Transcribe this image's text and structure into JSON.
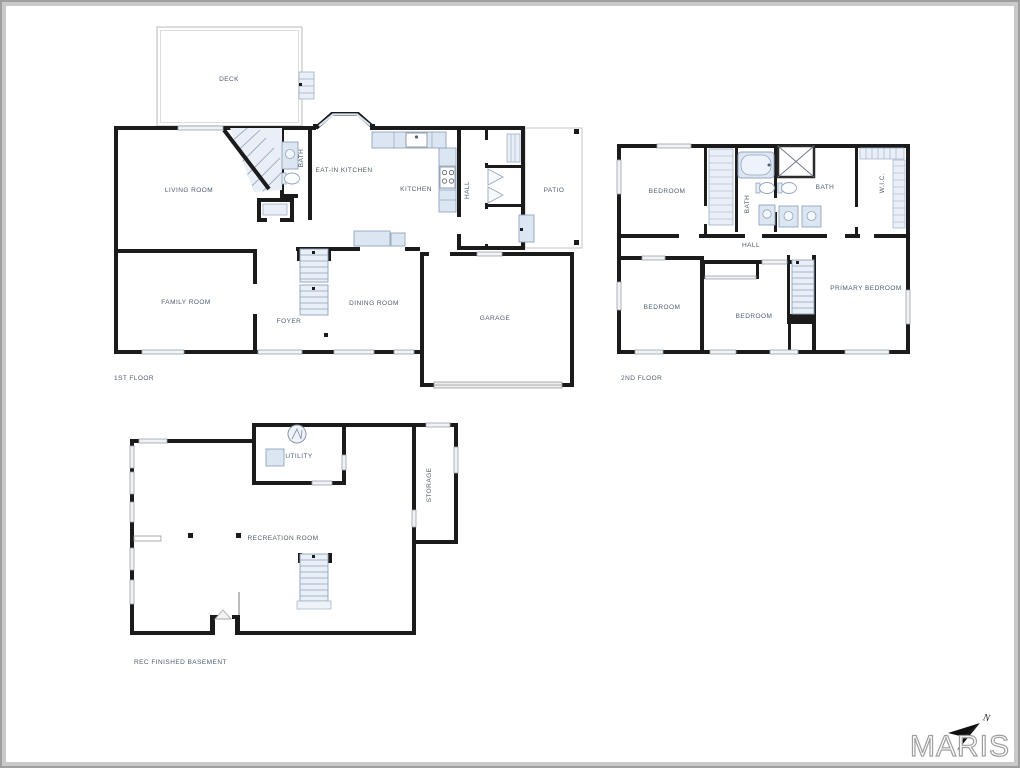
{
  "page": {
    "background": "#ffffff",
    "frame_outer_color": "#9e9e9e",
    "frame_inner_color": "#c9c9c9"
  },
  "palette": {
    "wall": "#1b1b1b",
    "fixture_fill": "#dce6f2",
    "fixture_stroke": "#92a5bd",
    "window_fill": "#f0f2f5",
    "label_color": "#4d5c6e",
    "logo_outline": "#9e9e9e"
  },
  "branding": {
    "logo_text": "MARIS",
    "north_label": "N"
  },
  "floors": [
    {
      "id": "first-floor",
      "title": "1ST FLOOR",
      "rooms": [
        {
          "label": "DECK"
        },
        {
          "label": "LIVING ROOM"
        },
        {
          "label": "BATH"
        },
        {
          "label": "EAT-IN KITCHEN"
        },
        {
          "label": "KITCHEN"
        },
        {
          "label": "HALL"
        },
        {
          "label": "PATIO"
        },
        {
          "label": "FAMILY ROOM"
        },
        {
          "label": "FOYER"
        },
        {
          "label": "DINING ROOM"
        },
        {
          "label": "GARAGE"
        }
      ]
    },
    {
      "id": "second-floor",
      "title": "2ND FLOOR",
      "rooms": [
        {
          "label": "BEDROOM"
        },
        {
          "label": "BATH"
        },
        {
          "label": "BATH"
        },
        {
          "label": "W.I.C."
        },
        {
          "label": "HALL"
        },
        {
          "label": "BEDROOM"
        },
        {
          "label": "BEDROOM"
        },
        {
          "label": "PRIMARY BEDROOM"
        }
      ]
    },
    {
      "id": "basement",
      "title": "REC FINISHED BASEMENT",
      "rooms": [
        {
          "label": "UTILITY"
        },
        {
          "label": "STORAGE"
        },
        {
          "label": "RECREATION ROOM"
        }
      ]
    }
  ]
}
